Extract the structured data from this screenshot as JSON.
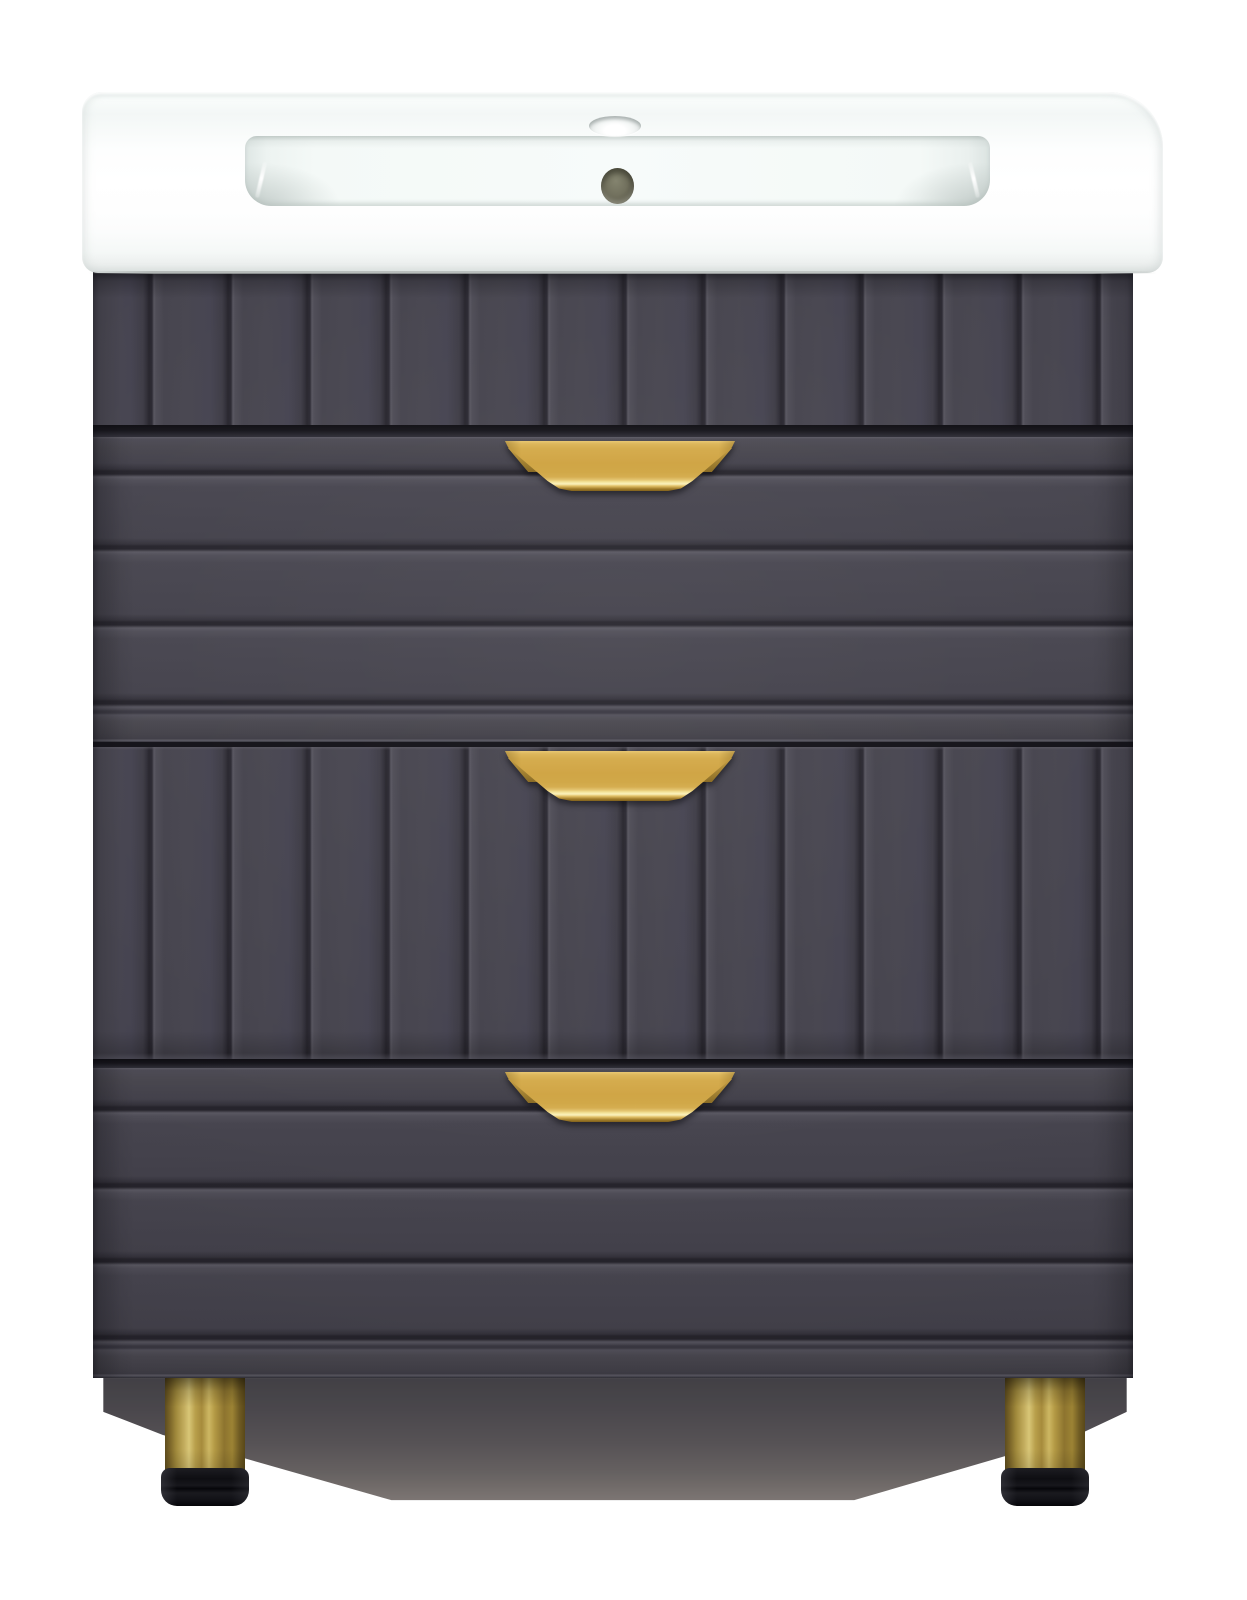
{
  "meta": {
    "description": "Product photograph of a freestanding bathroom vanity unit: glossy white ceramic washbasin top over a matte graphite-grey fluted cabinet with three drawers, gold half-moon cup pulls and two cylindrical brushed-brass legs with black adjustable feet, on a plain white background.",
    "background": "#ffffff"
  },
  "scene": {
    "type": "product-photo",
    "subject": "bathroom vanity with washbasin"
  },
  "parts": {
    "sink": {
      "name": "ceramic washbasin top",
      "finish": "glossy white",
      "features": {
        "faucet_hole": "single oval tap hole, top centre",
        "overflow_hole": "round open overflow below tap hole",
        "basin": "wide rectangular recessed bowl with rounded front corners"
      }
    },
    "cabinet": {
      "name": "vanity cabinet",
      "finish": "matte graphite grey",
      "drawer_count": 3,
      "panels": [
        {
          "id": "apron",
          "pattern": "vertical-slats"
        },
        {
          "id": "drawer-1",
          "pattern": "horizontal-planks",
          "handle": "gold cup pull"
        },
        {
          "id": "drawer-2",
          "pattern": "vertical-slats",
          "handle": "gold cup pull"
        },
        {
          "id": "drawer-3",
          "pattern": "horizontal-planks",
          "handle": "gold cup pull"
        }
      ]
    },
    "handles": {
      "count": 3,
      "shape": "half-moon trapezoid cup pull",
      "finish": "brushed gold"
    },
    "legs": {
      "count": 2,
      "shape": "cylinder",
      "finish": "brushed brass",
      "feet": "black adjustable glides"
    }
  },
  "colors": {
    "background": "#ffffff",
    "sink_white": "#ffffff",
    "basin_tint": "#eaf0ee",
    "overflow_olive": "#72715e",
    "cab_base": "#45434d",
    "cab_groove": "#26242c",
    "cab_groove_hi": "#57555f",
    "cab_gap": "#15141a",
    "handle_gold": "#d0a546",
    "handle_gold_top": "#e9c873",
    "handle_gold_hi": "#faf1bd",
    "handle_gold_dark": "#81611d",
    "leg_brass": "#a18a3c",
    "leg_brass_light": "#d8c677",
    "leg_brass_dark": "#594818",
    "foot_black": "#0e0e12",
    "shadow_dark": "#3b393f",
    "shadow_fade": "#7b7472"
  }
}
